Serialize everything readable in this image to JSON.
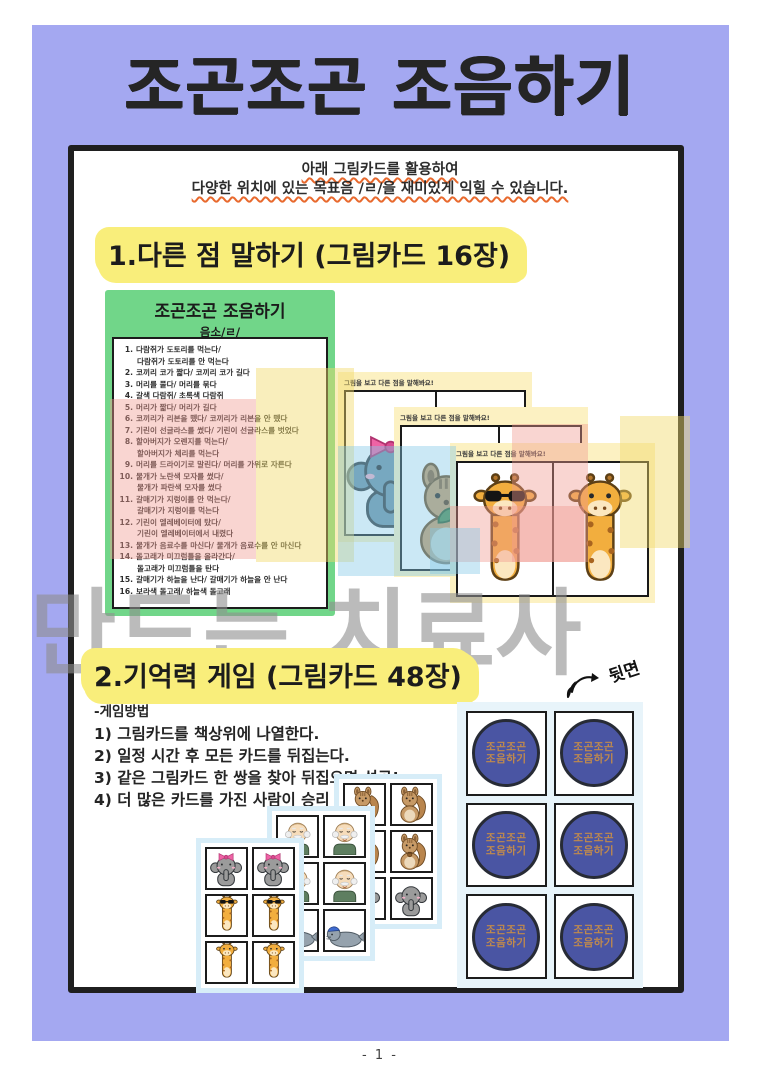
{
  "page": {
    "title": "조곤조곤 조음하기",
    "page_number": "- 1 -"
  },
  "intro": {
    "line1": "아래 그림카드를 활용하여",
    "line2": "다양한 위치에 있는 목표음 /ㄹ/을 재미있게 익힐 수 있습니다."
  },
  "section1": {
    "heading": "1.다른 점 말하기 (그림카드 16장)",
    "list_card": {
      "title": "조곤조곤 조음하기",
      "subtitle": "음소/ㄹ/",
      "items": [
        {
          "num": "1.",
          "lines": [
            "다람쥐가 도토리를 먹는다/",
            "다람쥐가 도토리를 안 먹는다"
          ]
        },
        {
          "num": "2.",
          "lines": [
            "코끼리 코가 짧다/ 코끼리 코가 길다"
          ]
        },
        {
          "num": "3.",
          "lines": [
            "머리를 풀다/ 머리를 묶다"
          ]
        },
        {
          "num": "4.",
          "lines": [
            "갈색 다람쥐/ 초록색 다람쥐"
          ]
        },
        {
          "num": "5.",
          "lines": [
            "머리가 짧다/ 머리가 길다"
          ]
        },
        {
          "num": "6.",
          "lines": [
            "코끼리가 리본을 뗐다/ 코끼리가 리본을 안 뗐다"
          ]
        },
        {
          "num": "7.",
          "lines": [
            "기린이 선글라스를 썼다/ 기린이 선글라스를 벗었다"
          ]
        },
        {
          "num": "8.",
          "lines": [
            "할아버지가 오렌지를 먹는다/",
            "할아버지가 체리를 먹는다"
          ]
        },
        {
          "num": "9.",
          "lines": [
            "머리를 드라이기로 말린다/ 머리를 가위로 자른다"
          ]
        },
        {
          "num": "10.",
          "lines": [
            "물개가 노란색 모자를 썼다/",
            "물개가 파란색 모자를 썼다"
          ]
        },
        {
          "num": "11.",
          "lines": [
            "갈매기가 지렁이를 안 먹는다/",
            "갈매기가 지렁이를 먹는다"
          ]
        },
        {
          "num": "12.",
          "lines": [
            "기린이 엘레베이터에 탔다/",
            "기린이 엘레베이터에서 내렸다"
          ]
        },
        {
          "num": "13.",
          "lines": [
            "물개가 음료수를 마신다/ 물개가 음료수를 안 마신다"
          ]
        },
        {
          "num": "14.",
          "lines": [
            "돌고래가 미끄럼틀을 올라간다/",
            "돌고래가 미끄럼틀을 탄다"
          ]
        },
        {
          "num": "15.",
          "lines": [
            "갈매기가 하늘을 난다/ 갈매기가 하늘을 안 난다"
          ]
        },
        {
          "num": "16.",
          "lines": [
            "보라색 돌고래/ 하늘색 돌고래"
          ]
        }
      ]
    },
    "picture_cards": [
      {
        "header": "그림을 보고 다른 점을 말해봐요!",
        "left": "elephant-bow-blue",
        "right": "elephant-bow-blue"
      },
      {
        "header": "그림을 보고 다른 점을 말해봐요!",
        "left": "squirrel-leaf",
        "right": "squirrel"
      },
      {
        "header": "그림을 보고 다른 점을 말해봐요!",
        "left": "giraffe-sunglasses",
        "right": "giraffe"
      }
    ]
  },
  "watermark": {
    "text": "만드는 치료사"
  },
  "section2": {
    "heading": "2.기억력 게임 (그림카드 48장)",
    "back_label": "뒷면",
    "method_title": "-게임방법",
    "steps": [
      "1) 그림카드를 책상위에 나열한다.",
      "2) 일정 시간 후 모든 카드를 뒤집는다.",
      "3) 같은 그림카드 한 쌍을 찾아 뒤집으면 성공!",
      "4) 더 많은 카드를 가진 사람이 승리"
    ],
    "memory_sheets": [
      {
        "name": "back",
        "animals": [
          "squirrel",
          "squirrel",
          "squirrel-acorn",
          "squirrel-acorn",
          "elephant",
          "elephant"
        ]
      },
      {
        "name": "middle",
        "animals": [
          "grandpa",
          "grandpa",
          "grandpa",
          "grandpa",
          "seal",
          "seal"
        ]
      },
      {
        "name": "front",
        "animals": [
          "elephant-bow",
          "elephant-bow",
          "giraffe-sunglasses",
          "giraffe-sunglasses",
          "giraffe",
          "giraffe"
        ]
      }
    ],
    "card_back": {
      "line1": "조곤조곤",
      "line2": "조음하기",
      "count": 6
    }
  },
  "colors": {
    "background_purple": "#a4a8f1",
    "highlight_yellow": "#f9ee7b",
    "list_card_green": "#71d689",
    "card_back_blue": "#4a55a3",
    "card_back_text": "#c08a4d",
    "underline_orange": "#e8692d",
    "watermark_gray": "#8f8f8f"
  }
}
